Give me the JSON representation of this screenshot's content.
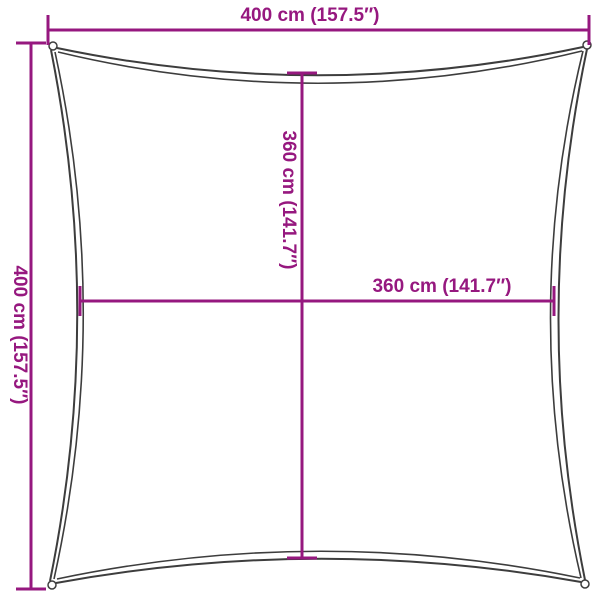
{
  "colors": {
    "dim": "#96187F",
    "outline": "#3D3D3D",
    "bg": "#FFFFFF"
  },
  "dimensions": {
    "top": {
      "label": "400 cm (157.5″)",
      "cm": 400,
      "inches": 157.5
    },
    "left": {
      "label": "400 cm (157.5″)",
      "cm": 400,
      "inches": 157.5
    },
    "inner_vertical": {
      "label": "360 cm (141.7″)",
      "cm": 360,
      "inches": 141.7
    },
    "inner_horizontal": {
      "label": "360 cm (141.7″)",
      "cm": 360,
      "inches": 141.7
    }
  }
}
